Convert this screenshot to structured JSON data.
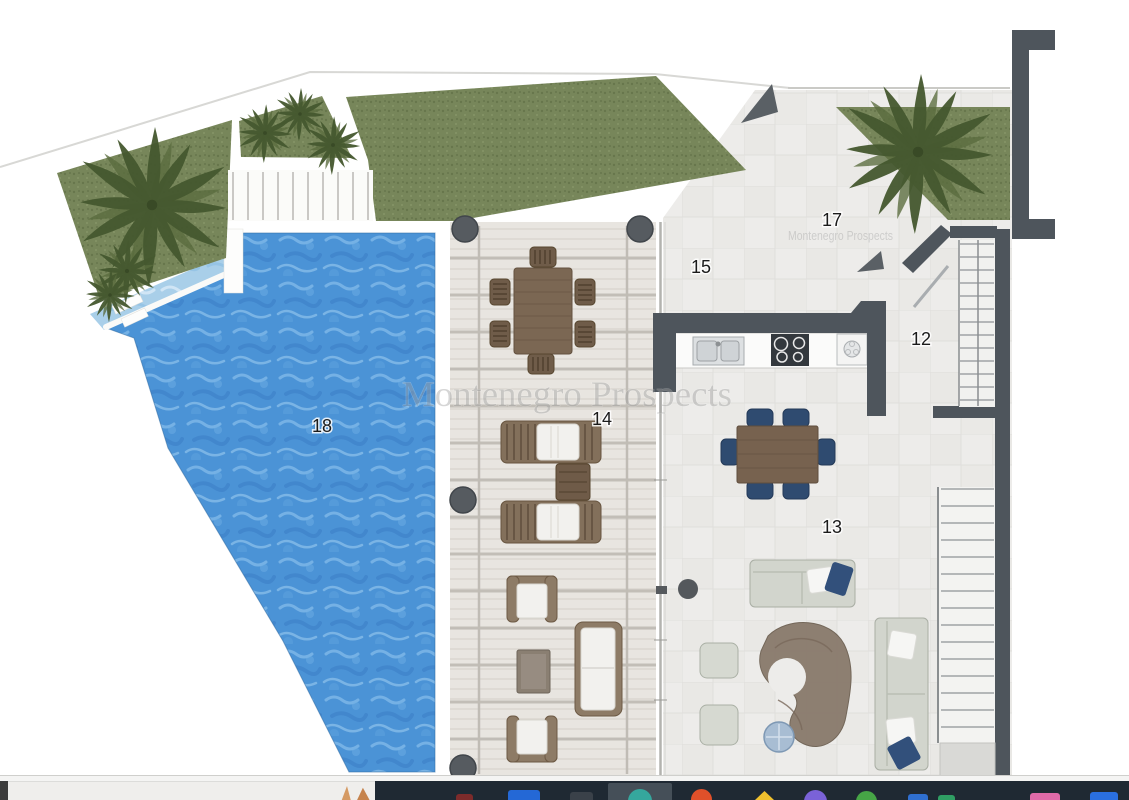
{
  "floorplan": {
    "watermark": "Montenegro Prospects",
    "watermark_secondary": "Montenegro Prospects",
    "rooms": [
      {
        "id": "entrance-courtyard",
        "number": "17"
      },
      {
        "id": "kitchen-dining",
        "number": "15"
      },
      {
        "id": "staircase-hall",
        "number": "12"
      },
      {
        "id": "covered-terrace",
        "number": "14"
      },
      {
        "id": "living-room",
        "number": "13"
      },
      {
        "id": "swimming-pool",
        "number": "18"
      }
    ],
    "colors": {
      "pool_water": "#4b93d6",
      "pool_shallow": "#a9cfe9",
      "grass": "#77865a",
      "palm": "#45582f",
      "wall": "#4e555c",
      "deck": "#e8e5e0",
      "tile_floor": "#edecea",
      "dining_chair_navy": "#2f4b70",
      "wood_furniture": "#7b6753"
    }
  },
  "taskbar": {
    "background": "#1f2933",
    "left_section_color": "#efeeec",
    "highlight": {
      "x": 608,
      "width": 64,
      "color": "#454f58"
    },
    "icons": [
      {
        "name": "app-red",
        "x": 456,
        "w": 17,
        "h": 6,
        "color": "#7d2b2b",
        "shape": "square"
      },
      {
        "name": "app-blue-window",
        "x": 508,
        "w": 32,
        "h": 10,
        "color": "#2468d6",
        "shape": "square"
      },
      {
        "name": "app-dark-square",
        "x": 570,
        "w": 23,
        "h": 8,
        "color": "#3a4149",
        "shape": "square"
      },
      {
        "name": "app-teal-circle",
        "x": 628,
        "w": 24,
        "h": 11,
        "color": "#35a79d",
        "shape": "circle"
      },
      {
        "name": "app-orange-circle",
        "x": 691,
        "w": 21,
        "h": 11,
        "color": "#e0502a",
        "shape": "circle"
      },
      {
        "name": "app-yellow-triangle",
        "x": 755,
        "w": 19,
        "h": 9,
        "color": "#f0c02e",
        "shape": "triangle"
      },
      {
        "name": "app-purple-circle",
        "x": 804,
        "w": 23,
        "h": 10,
        "color": "#7a62d8",
        "shape": "circle"
      },
      {
        "name": "app-green-circle",
        "x": 856,
        "w": 21,
        "h": 9,
        "color": "#46a546",
        "shape": "circle"
      },
      {
        "name": "app-blue-2",
        "x": 908,
        "w": 20,
        "h": 6,
        "color": "#2f6fd0",
        "shape": "square"
      },
      {
        "name": "app-green-2",
        "x": 938,
        "w": 17,
        "h": 5,
        "color": "#2f9e63",
        "shape": "square"
      },
      {
        "name": "app-photos",
        "x": 1030,
        "w": 30,
        "h": 7,
        "color": "#e06aa8",
        "shape": "square"
      },
      {
        "name": "app-blue-3",
        "x": 1090,
        "w": 28,
        "h": 8,
        "color": "#2a6fe0",
        "shape": "square"
      }
    ]
  }
}
